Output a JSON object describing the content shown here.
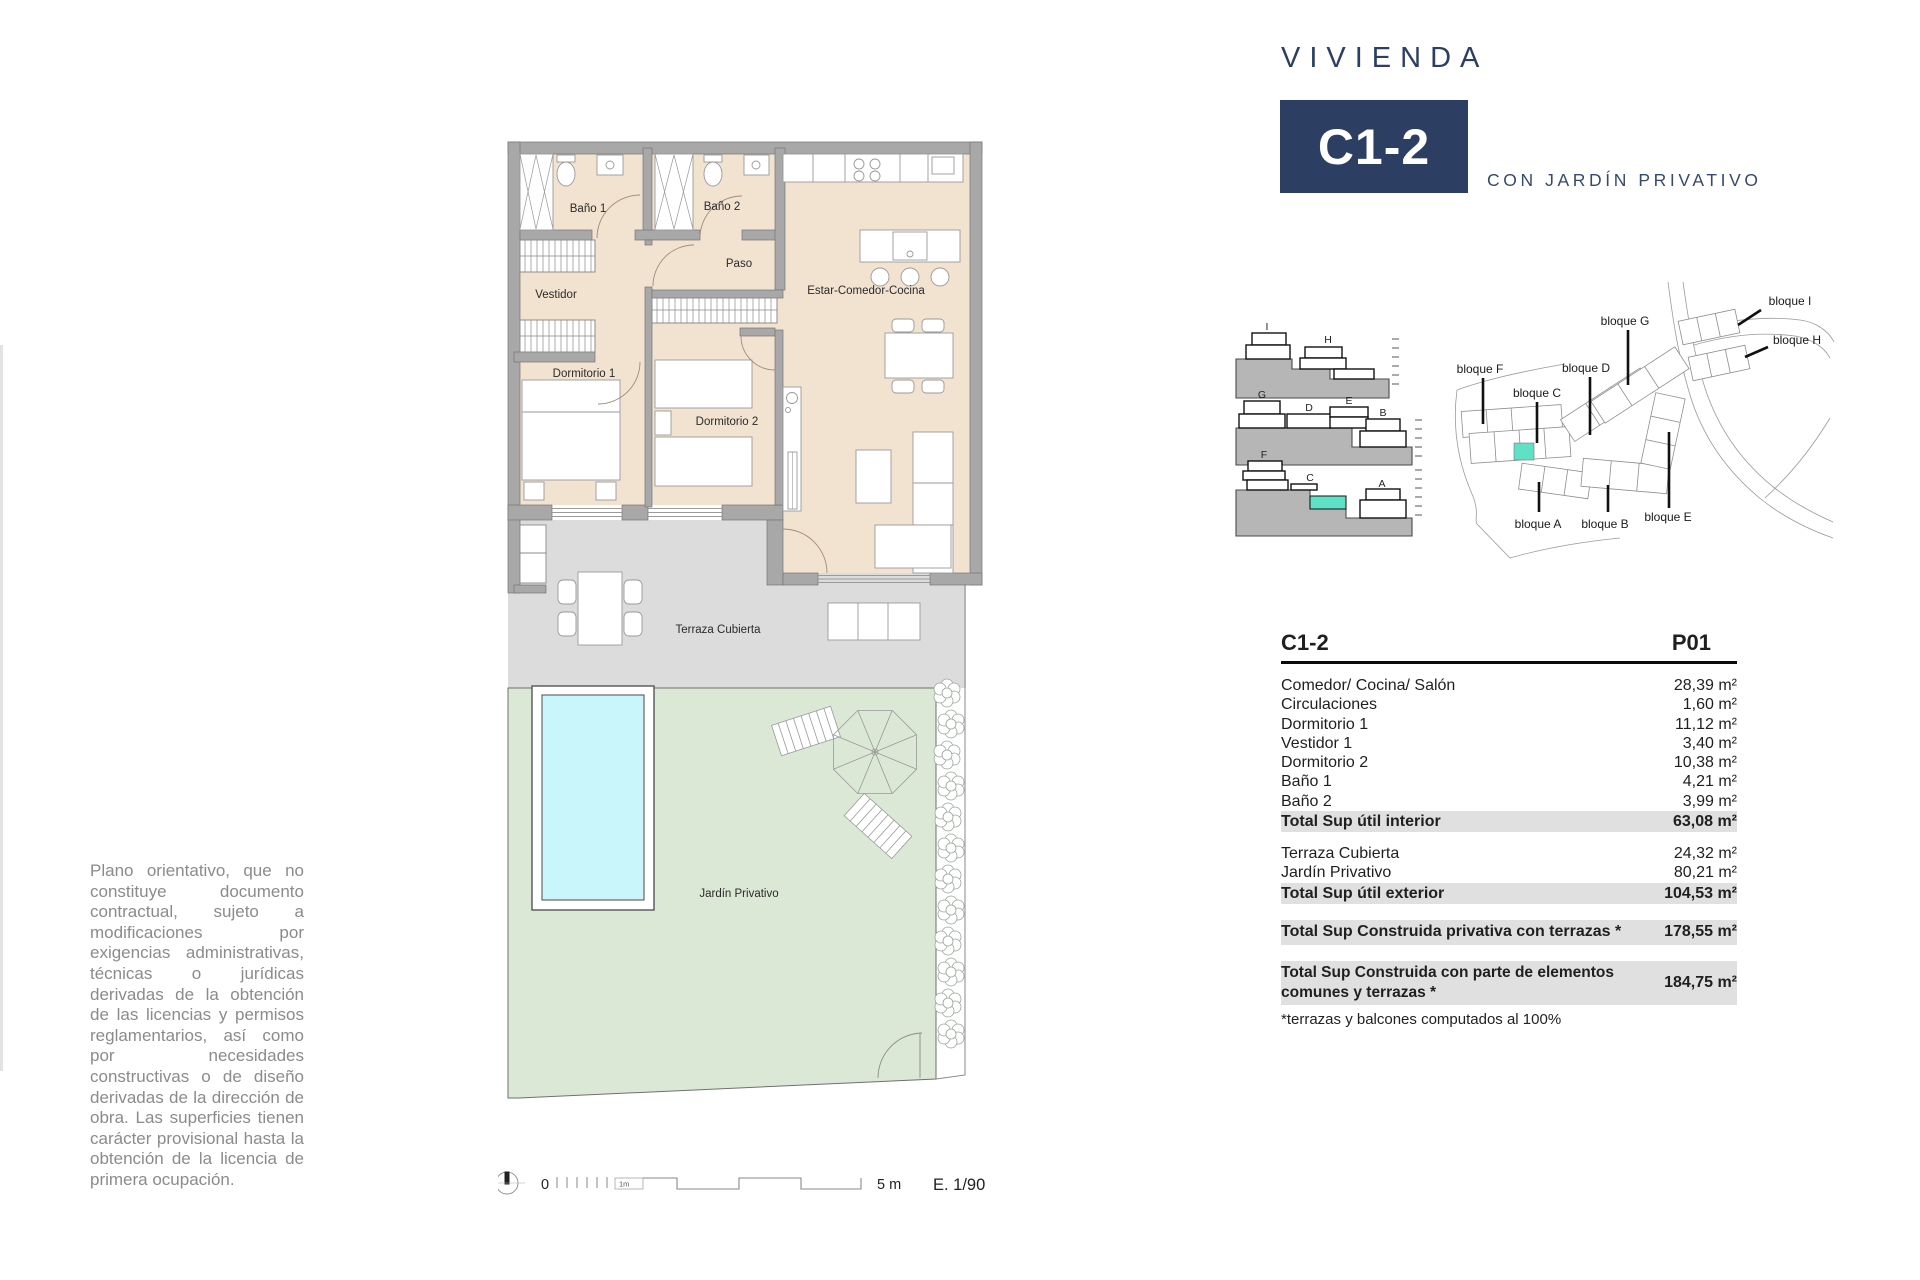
{
  "header": {
    "brand": "VIVIENDA",
    "unit": "C1-2",
    "subtitle": "CON JARDÍN PRIVATIVO"
  },
  "colors": {
    "accent_navy": "#2c3f63",
    "highlight_teal": "#5ee1c5",
    "floor_beige": "#f2e3d0",
    "terrace_gray": "#dcdcdc",
    "garden_green": "#dce8d6",
    "pool_cyan": "#c9f6fa",
    "total_row_gray": "#e0e0e0"
  },
  "plan": {
    "rooms": {
      "bano1": "Baño 1",
      "bano2": "Baño 2",
      "paso": "Paso",
      "vestidor": "Vestidor",
      "dormitorio1": "Dormitorio 1",
      "dormitorio2": "Dormitorio 2",
      "estar": "Estar-Comedor-Cocina",
      "terraza": "Terraza Cubierta",
      "jardin": "Jardín Privativo"
    }
  },
  "elevations": {
    "row1": [
      "I",
      "H"
    ],
    "row2": [
      "G",
      "D",
      "E",
      "B"
    ],
    "row3": [
      "F",
      "C",
      "A"
    ]
  },
  "siteplan": {
    "labels": {
      "f": "bloque F",
      "c": "bloque C",
      "g": "bloque G",
      "d": "bloque D",
      "i": "bloque I",
      "h": "bloque H",
      "a": "bloque A",
      "b": "bloque B",
      "e": "bloque E"
    }
  },
  "table": {
    "unit": "C1-2",
    "floor": "P01",
    "interior": [
      {
        "label": "Comedor/ Cocina/ Salón",
        "value": "28,39 m²"
      },
      {
        "label": "Circulaciones",
        "value": "1,60 m²"
      },
      {
        "label": "Dormitorio 1",
        "value": "11,12 m²"
      },
      {
        "label": "Vestidor 1",
        "value": "3,40 m²"
      },
      {
        "label": "Dormitorio 2",
        "value": "10,38 m²"
      },
      {
        "label": "Baño 1",
        "value": "4,21 m²"
      },
      {
        "label": "Baño 2",
        "value": "3,99 m²"
      }
    ],
    "total_interior": {
      "label": "Total Sup útil interior",
      "value": "63,08 m²"
    },
    "exterior": [
      {
        "label": "Terraza Cubierta",
        "value": "24,32 m²"
      },
      {
        "label": "Jardín Privativo",
        "value": "80,21 m²"
      }
    ],
    "total_exterior": {
      "label": "Total Sup útil exterior",
      "value": "104,53 m²"
    },
    "total_privativa": {
      "label": "Total Sup Construida privativa con terrazas *",
      "value": "178,55 m²"
    },
    "total_comunes": {
      "label": "Total Sup Construida con parte de elementos comunes y terrazas *",
      "value": "184,75 m²"
    },
    "footnote": "*terrazas y balcones computados al 100%"
  },
  "scalebar": {
    "zero": "0",
    "one_m": "1m",
    "five_m": "5 m",
    "scale": "E. 1/90"
  },
  "disclaimer": {
    "text": "Plano orientativo, que no constituye documento contractual, sujeto a modificaciones por exigencias administrativas, técnicas o jurídicas derivadas de la obtención de las licencias y permisos reglamentarios, así como por necesidades constructivas o de diseño derivadas de la dirección de obra. Las superficies tienen carácter provisional hasta la obtención de la licencia de primera ocupación."
  }
}
